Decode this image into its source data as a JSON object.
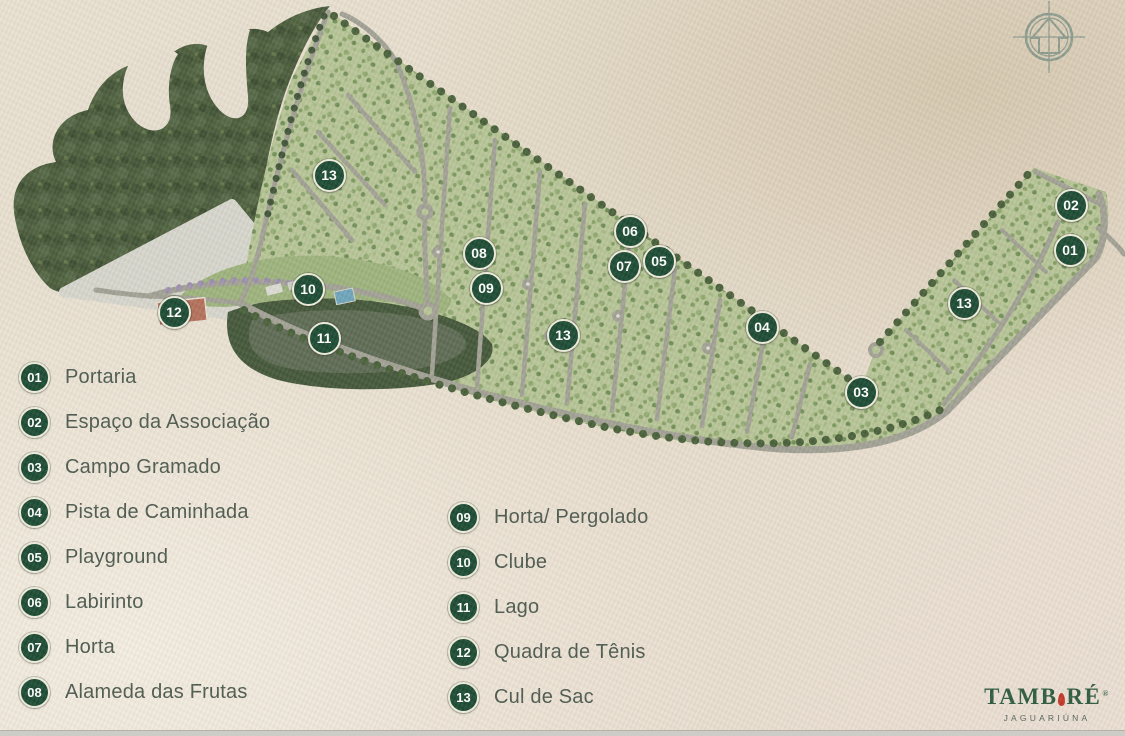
{
  "legend": {
    "column1": [
      {
        "num": "01",
        "label": "Portaria"
      },
      {
        "num": "02",
        "label": "Espaço da Associação"
      },
      {
        "num": "03",
        "label": "Campo Gramado"
      },
      {
        "num": "04",
        "label": "Pista de Caminhada"
      },
      {
        "num": "05",
        "label": "Playground"
      },
      {
        "num": "06",
        "label": "Labirinto"
      },
      {
        "num": "07",
        "label": "Horta"
      },
      {
        "num": "08",
        "label": "Alameda das Frutas"
      }
    ],
    "column2": [
      {
        "num": "09",
        "label": "Horta/ Pergolado"
      },
      {
        "num": "10",
        "label": "Clube"
      },
      {
        "num": "11",
        "label": "Lago"
      },
      {
        "num": "12",
        "label": "Quadra de Tênis"
      },
      {
        "num": "13",
        "label": "Cul de Sac"
      }
    ]
  },
  "map_markers": [
    {
      "num": "13",
      "x": 327,
      "y": 173
    },
    {
      "num": "08",
      "x": 477,
      "y": 251
    },
    {
      "num": "09",
      "x": 484,
      "y": 286
    },
    {
      "num": "10",
      "x": 306,
      "y": 287
    },
    {
      "num": "11",
      "x": 322,
      "y": 336
    },
    {
      "num": "12",
      "x": 172,
      "y": 310
    },
    {
      "num": "06",
      "x": 628,
      "y": 229
    },
    {
      "num": "07",
      "x": 622,
      "y": 264
    },
    {
      "num": "05",
      "x": 657,
      "y": 259
    },
    {
      "num": "04",
      "x": 760,
      "y": 325
    },
    {
      "num": "13",
      "x": 561,
      "y": 333
    },
    {
      "num": "03",
      "x": 859,
      "y": 390
    },
    {
      "num": "13",
      "x": 962,
      "y": 301
    },
    {
      "num": "02",
      "x": 1069,
      "y": 203
    },
    {
      "num": "01",
      "x": 1068,
      "y": 248
    }
  ],
  "logo": {
    "brand_left": "TAMB",
    "brand_right": "RÉ",
    "registered": "®",
    "subtitle": "JAGUARIÚNA"
  },
  "colors": {
    "marker_fill": "#1b4a33",
    "marker_ring": "#f0eddd",
    "marker_text": "#ffffff",
    "legend_text": "#4d5a50",
    "logo_green": "#2e5c40",
    "logo_symbol": "#c3392a",
    "logo_subtitle": "#52625a"
  }
}
